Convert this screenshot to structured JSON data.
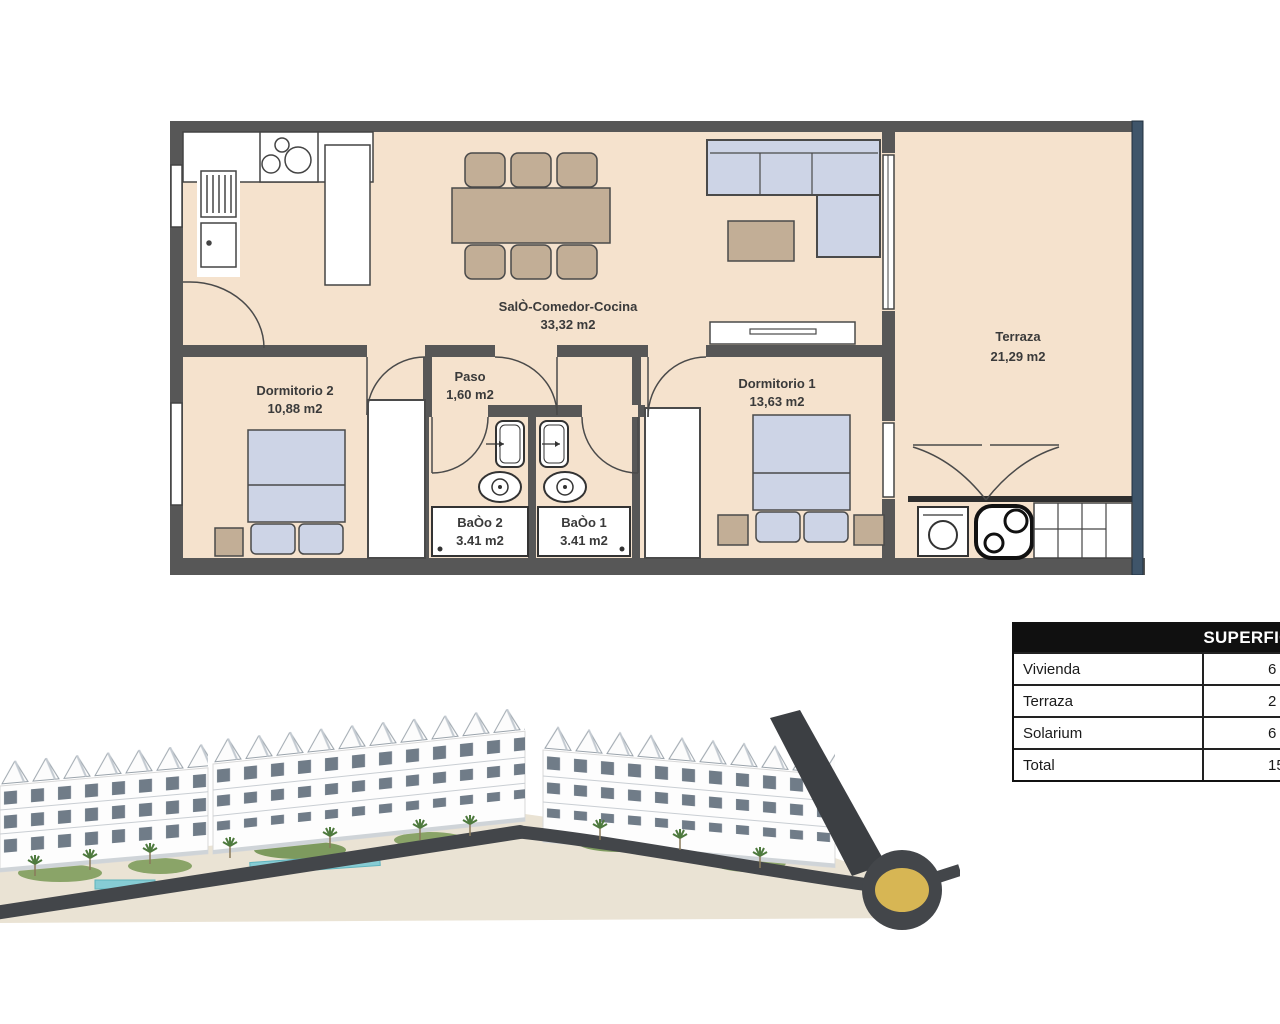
{
  "floor_plan": {
    "rooms": {
      "salon": {
        "name": "SalÒ-Comedor-Cocina",
        "area": "33,32 m2"
      },
      "paso": {
        "name": "Paso",
        "area": "1,60 m2"
      },
      "dormitorio2": {
        "name": "Dormitorio 2",
        "area": "10,88 m2"
      },
      "dormitorio1": {
        "name": "Dormitorio 1",
        "area": "13,63 m2"
      },
      "bano2": {
        "name": "BaÒo 2",
        "area": "3.41 m2"
      },
      "bano1": {
        "name": "BaÒo 1",
        "area": "3.41 m2"
      },
      "terraza": {
        "name": "Terraza",
        "area": "21,29 m2"
      }
    },
    "colors": {
      "wall": "#575757",
      "floor": "#f5e2cd",
      "furniture_blue": "#cdd4e6",
      "furniture_tan": "#c2ae96",
      "glass_rail": "#3f556a"
    }
  },
  "superficies_table": {
    "title": "SUPERFICIES",
    "rows": [
      {
        "label": "Vivienda",
        "value": "6"
      },
      {
        "label": "Terraza",
        "value": "2"
      },
      {
        "label": "Solarium",
        "value": "6"
      },
      {
        "label": "Total",
        "value": "15"
      }
    ]
  },
  "render_colors": {
    "road": "#43464a",
    "roundabout_center": "#d7b654",
    "pool": "#86ccd4",
    "greenery": "#8aa468",
    "ground": "#eae3d4",
    "building": "#fdfdfd"
  }
}
